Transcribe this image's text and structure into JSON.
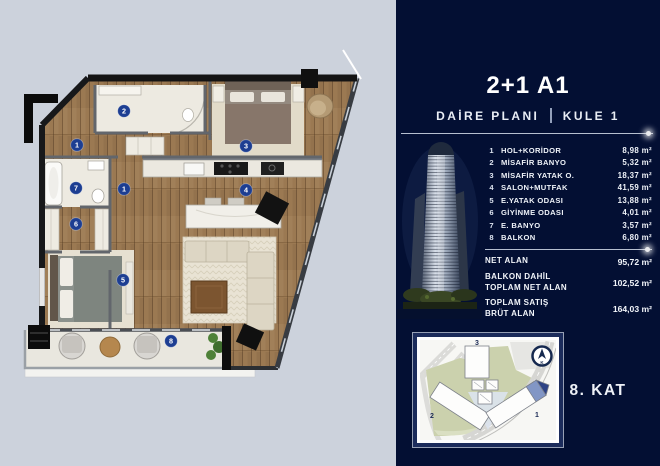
{
  "colors": {
    "panel_navy": "#030f33",
    "page_bg": "#ccd2dc",
    "marker_blue": "#1d3e92",
    "wood": "#9b7952",
    "map_border_navy": "#1c2c5c",
    "highlight_blue": "#8296c5"
  },
  "header": {
    "title": "2+1 A1",
    "plan_label": "DAİRE PLANI",
    "tower_label": "KULE 1"
  },
  "rooms": [
    {
      "no": "1",
      "name": "HOL+KORİDOR",
      "area": "8,98 m²"
    },
    {
      "no": "2",
      "name": "MİSAFİR BANYO",
      "area": "5,32 m²"
    },
    {
      "no": "3",
      "name": "MİSAFİR YATAK O.",
      "area": "18,37 m²"
    },
    {
      "no": "4",
      "name": "SALON+MUTFAK",
      "area": "41,59 m²"
    },
    {
      "no": "5",
      "name": "E.YATAK ODASI",
      "area": "13,88 m²"
    },
    {
      "no": "6",
      "name": "GİYİNME ODASI",
      "area": "4,01 m²"
    },
    {
      "no": "7",
      "name": "E. BANYO",
      "area": "3,57 m²"
    },
    {
      "no": "8",
      "name": "BALKON",
      "area": "6,80 m²"
    }
  ],
  "totals": [
    {
      "label": "NET ALAN",
      "label2": "",
      "value": "95,72 m²"
    },
    {
      "label": "BALKON DAHİL",
      "label2": "TOPLAM NET ALAN",
      "value": "102,52 m²"
    },
    {
      "label": "TOPLAM SATIŞ",
      "label2": "BRÜT ALAN",
      "value": "164,03 m²"
    }
  ],
  "floor_plan": {
    "markers": [
      "1",
      "1",
      "2",
      "3",
      "4",
      "5",
      "6",
      "7",
      "8"
    ]
  },
  "site_plan": {
    "wing_labels": [
      "1",
      "2",
      "3"
    ],
    "compass_letter": "K"
  },
  "page": {
    "floor_label": "8. KAT"
  }
}
